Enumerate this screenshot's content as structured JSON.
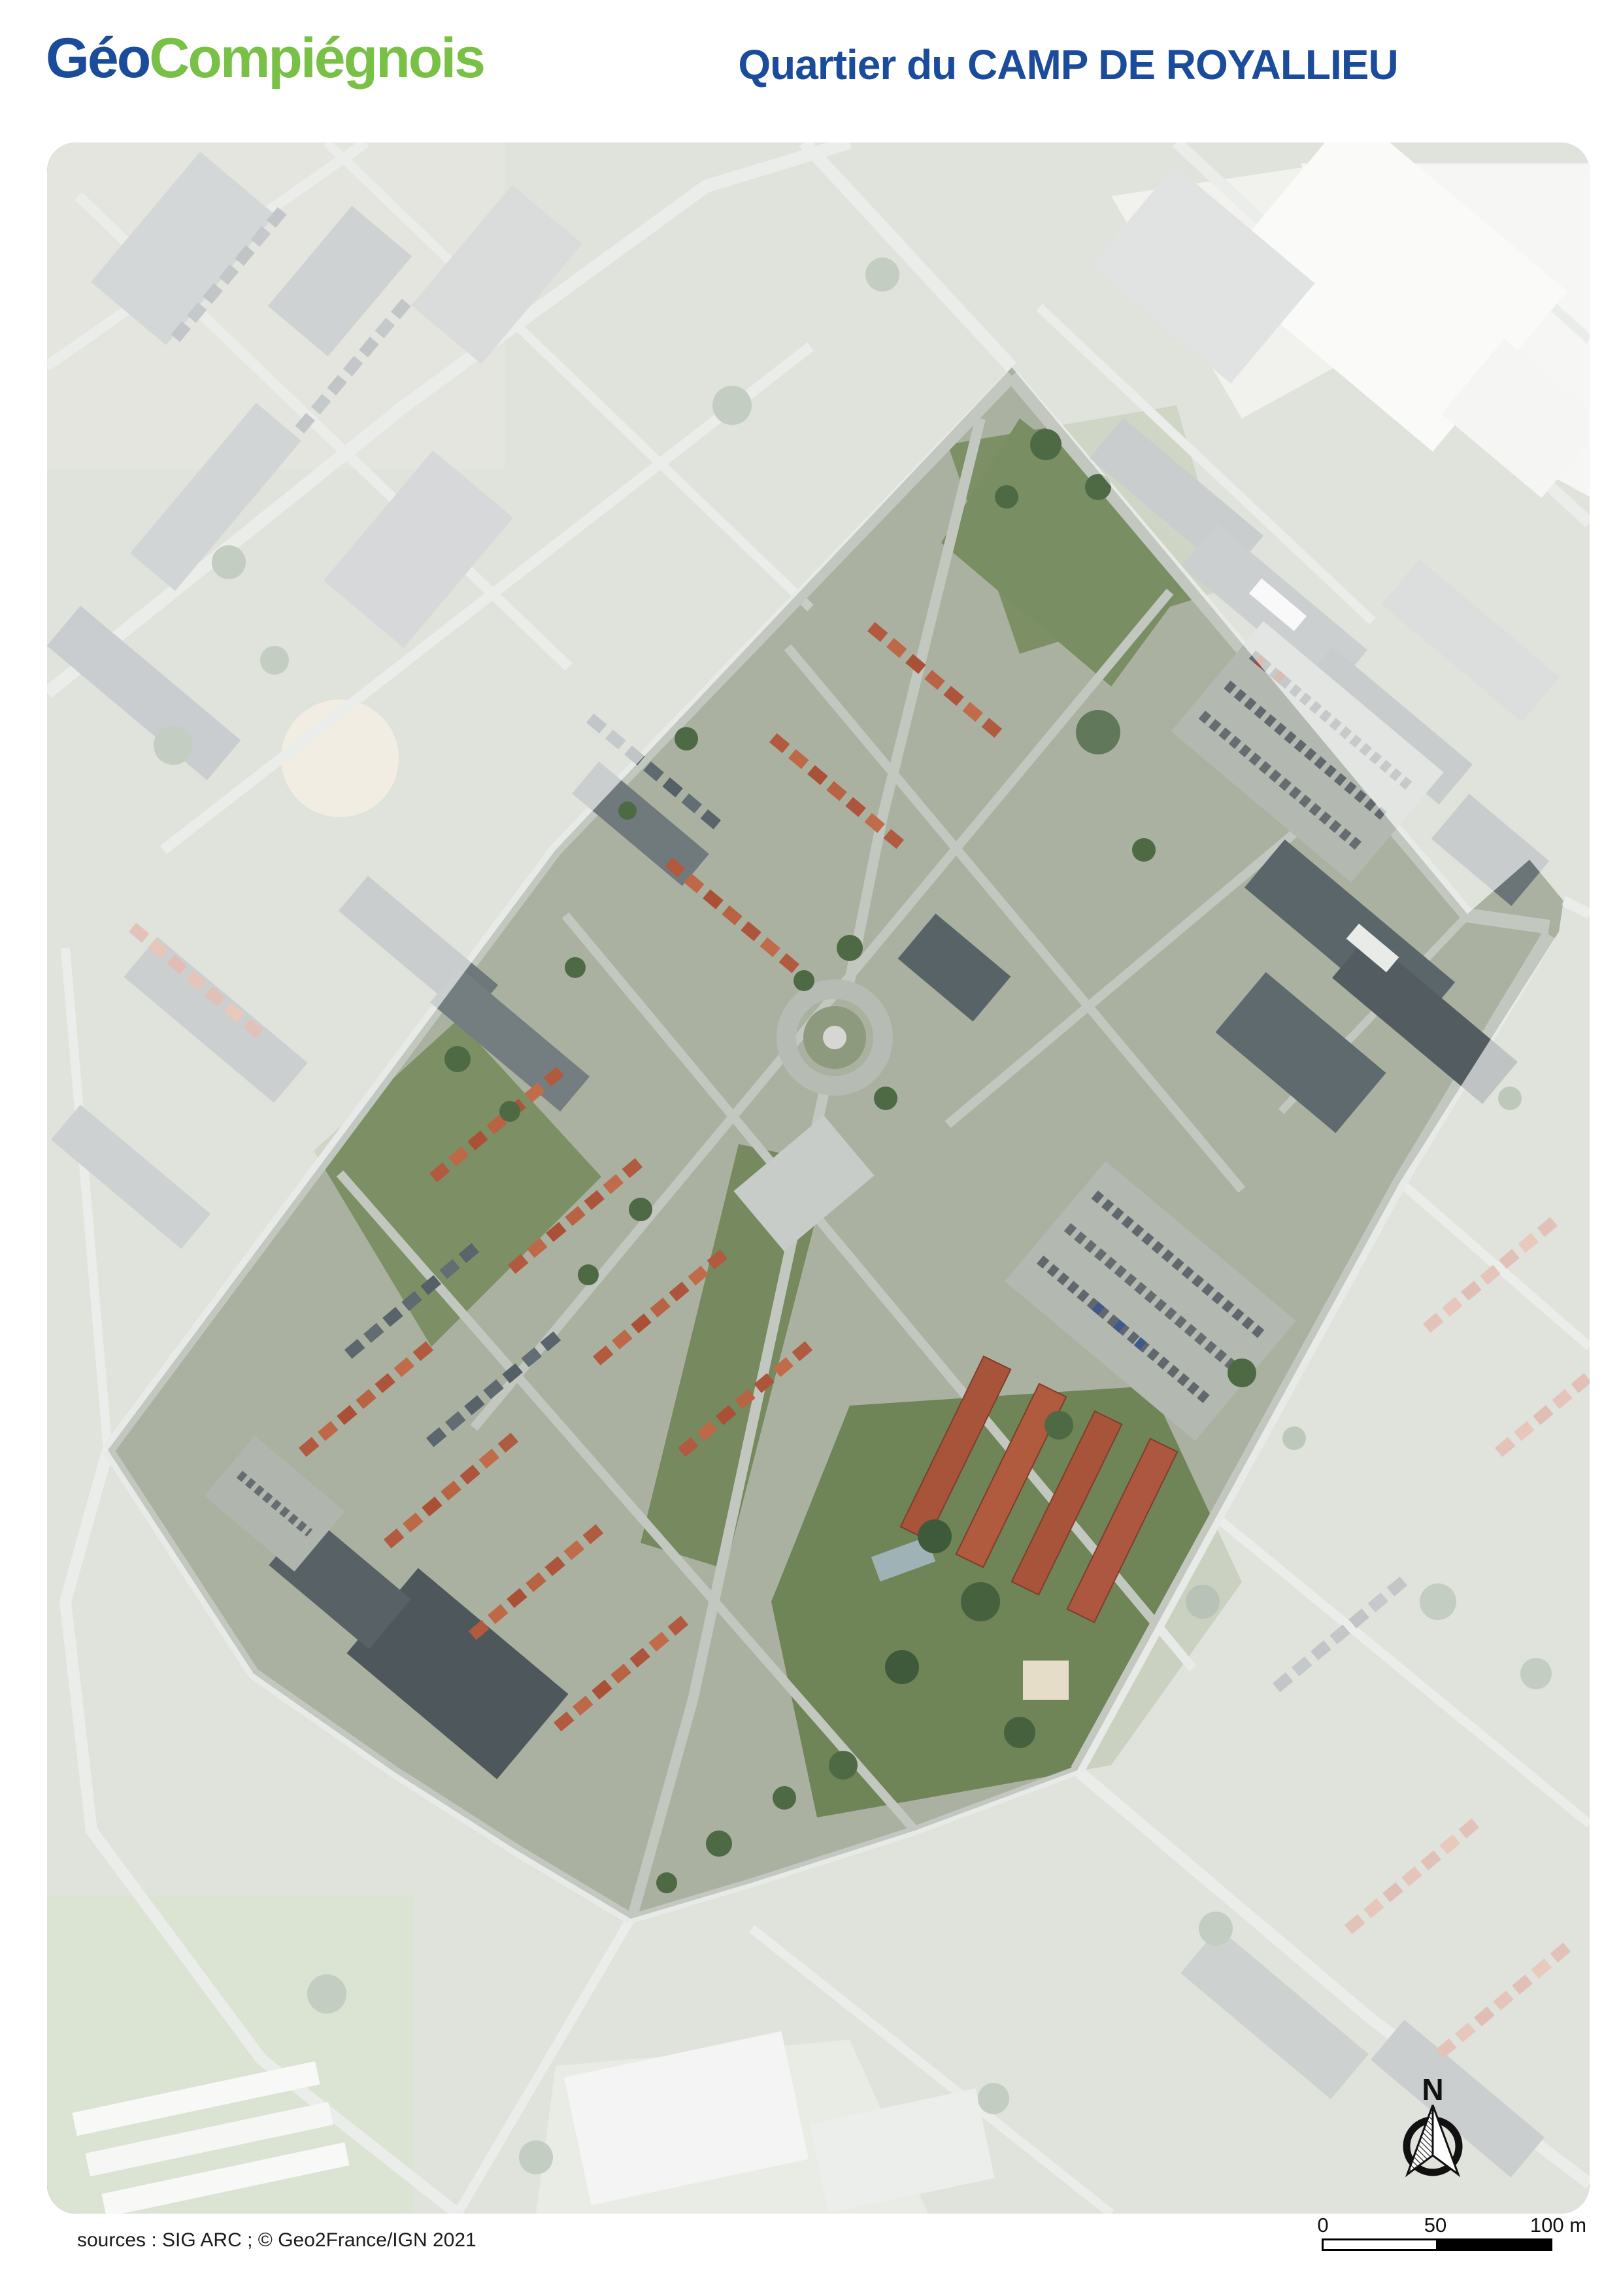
{
  "header": {
    "logo": {
      "text_blue": "Géo",
      "text_green": "Compiégnois",
      "blue_color": "#1b4c9b",
      "green_color": "#79c046"
    },
    "title": "Quartier du CAMP DE ROYALLIEU",
    "title_color": "#1b4c9b"
  },
  "map": {
    "kind": "aerial-orthophoto",
    "highlighted_area": "Quartier du Camp de Royallieu",
    "wash_color": "#ffffff",
    "wash_opacity": "0.63",
    "palette": {
      "ground": "#aab1a0",
      "road": "#c2c7c0",
      "grass": "#7b8f60",
      "tree": "#4e6a45",
      "dark_building": "#5b666b",
      "red_roof": "#b25a3f",
      "white_building": "#f1f2ef"
    }
  },
  "compass": {
    "north_label": "N"
  },
  "scale_bar": {
    "tick_0": "0",
    "tick_50": "50",
    "tick_100": "100 m"
  },
  "footer": {
    "sources": "sources : SIG ARC ; © Geo2France/IGN 2021"
  }
}
